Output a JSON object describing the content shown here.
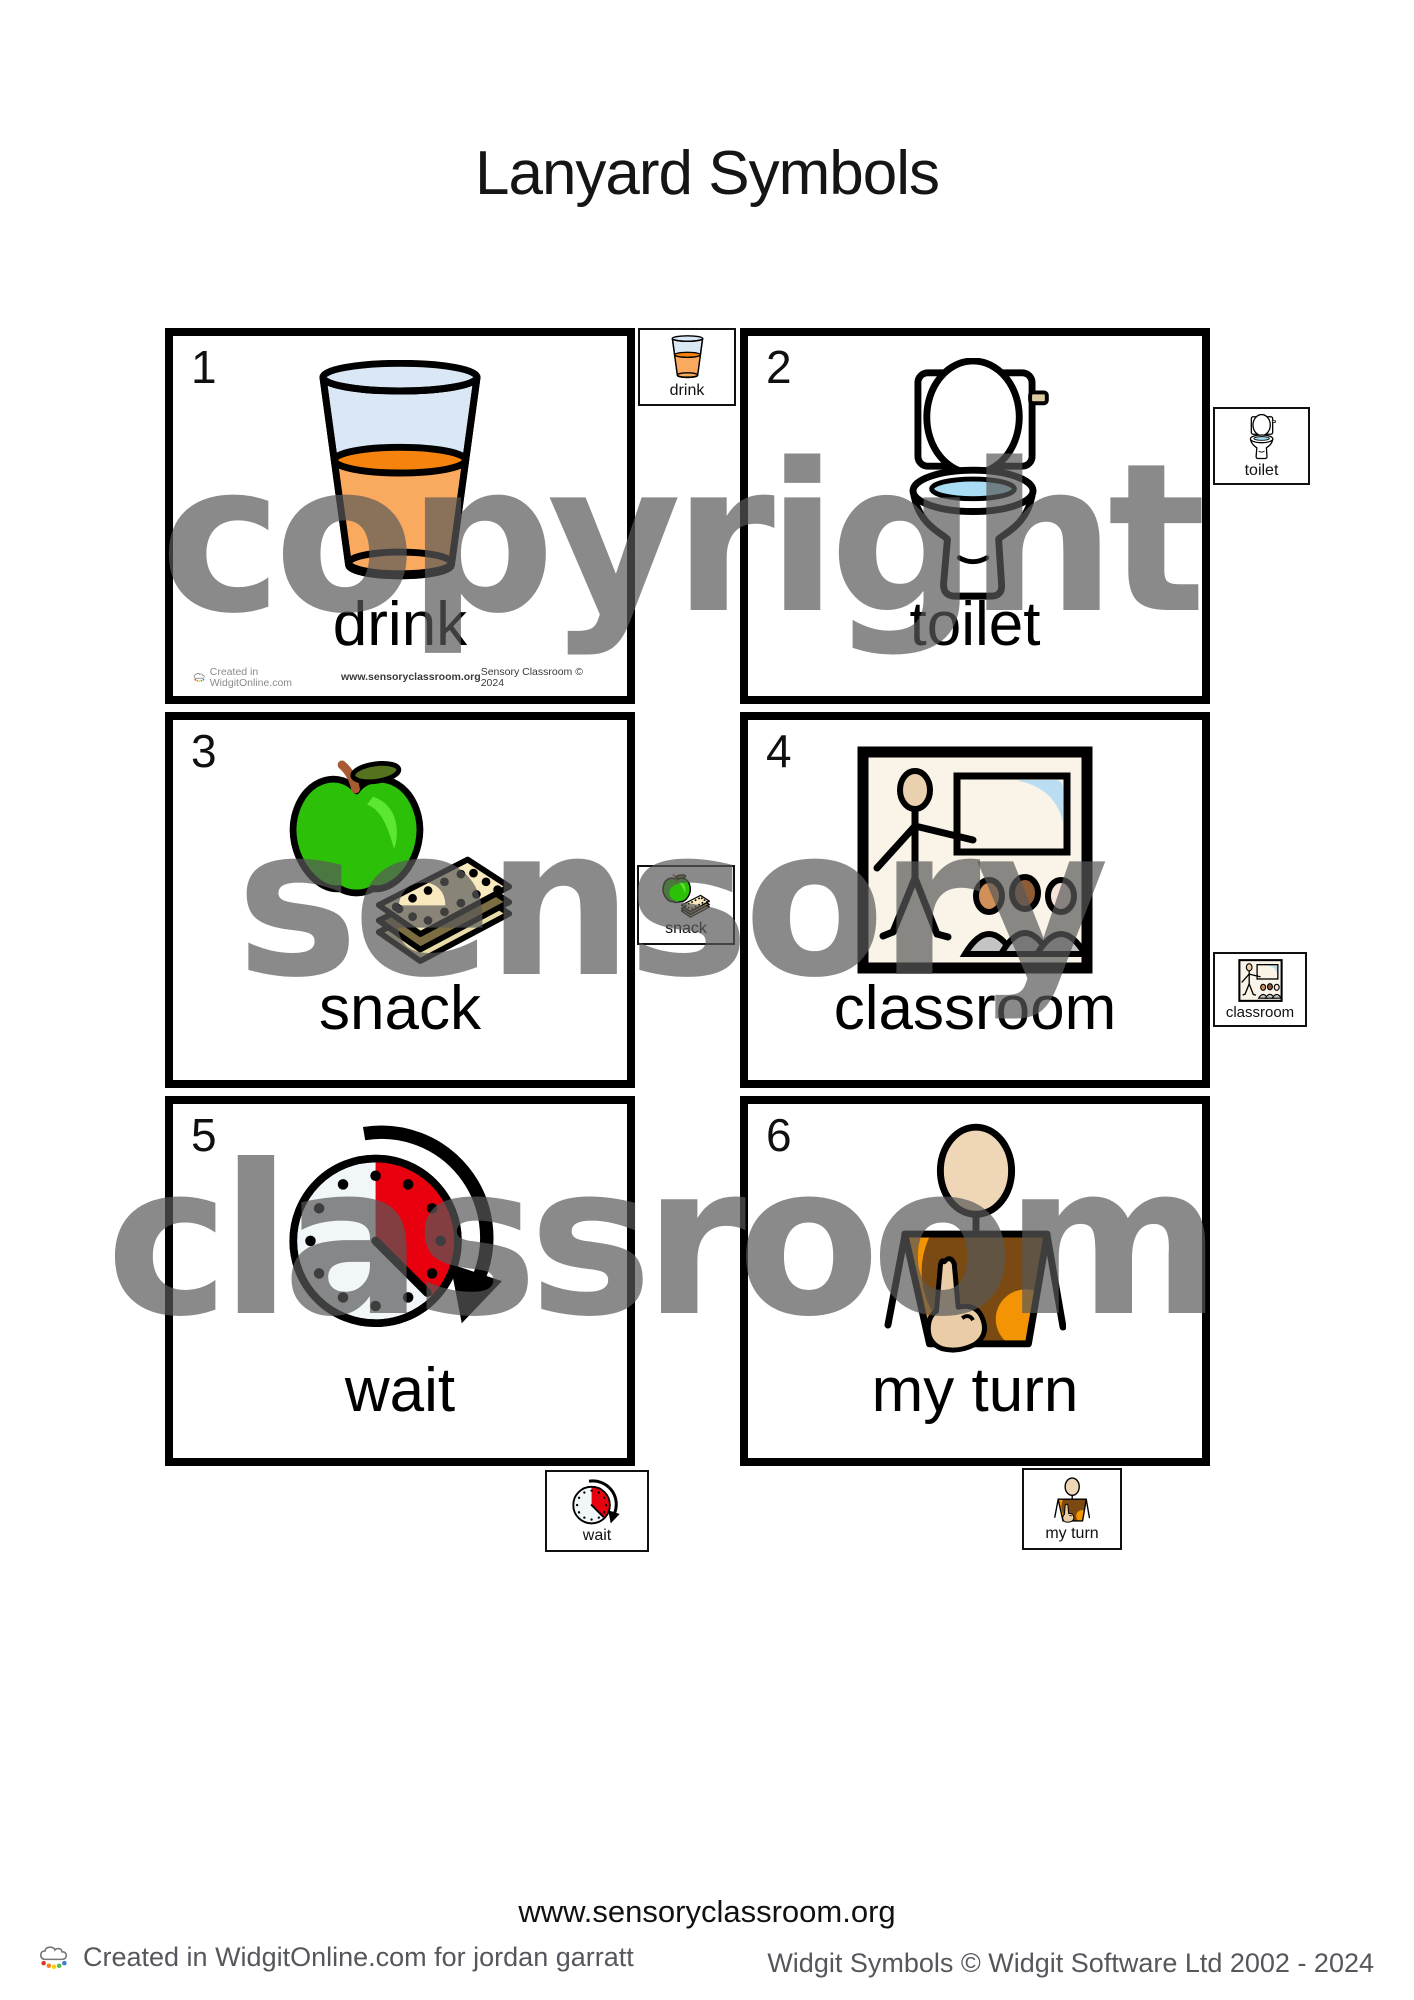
{
  "title": "Lanyard Symbols",
  "cards": [
    {
      "number": "1",
      "label": "drink"
    },
    {
      "number": "2",
      "label": "toilet"
    },
    {
      "number": "3",
      "label": "snack"
    },
    {
      "number": "4",
      "label": "classroom"
    },
    {
      "number": "5",
      "label": "wait"
    },
    {
      "number": "6",
      "label": "my turn"
    }
  ],
  "watermark": {
    "line1": "copyright",
    "line2": "sensory",
    "line3": "classroom",
    "color": "#8a8a8a"
  },
  "card1_credits": {
    "left": "Created in WidgitOnline.com",
    "center": "www.sensoryclassroom.org",
    "right": "Sensory Classroom © 2024"
  },
  "footer": {
    "website": "www.sensoryclassroom.org",
    "left": "Created in WidgitOnline.com for jordan garratt",
    "right": "Widgit Symbols © Widgit Software Ltd 2002 - 2024"
  },
  "colors": {
    "juice_orange": "#F5830D",
    "juice_light": "#FAAA5F",
    "glass_blue": "#D9E8F4",
    "apple_green": "#2CC108",
    "timer_red": "#E8000E",
    "shirt_orange": "#F39404",
    "water_blue": "#A9DDF3"
  }
}
